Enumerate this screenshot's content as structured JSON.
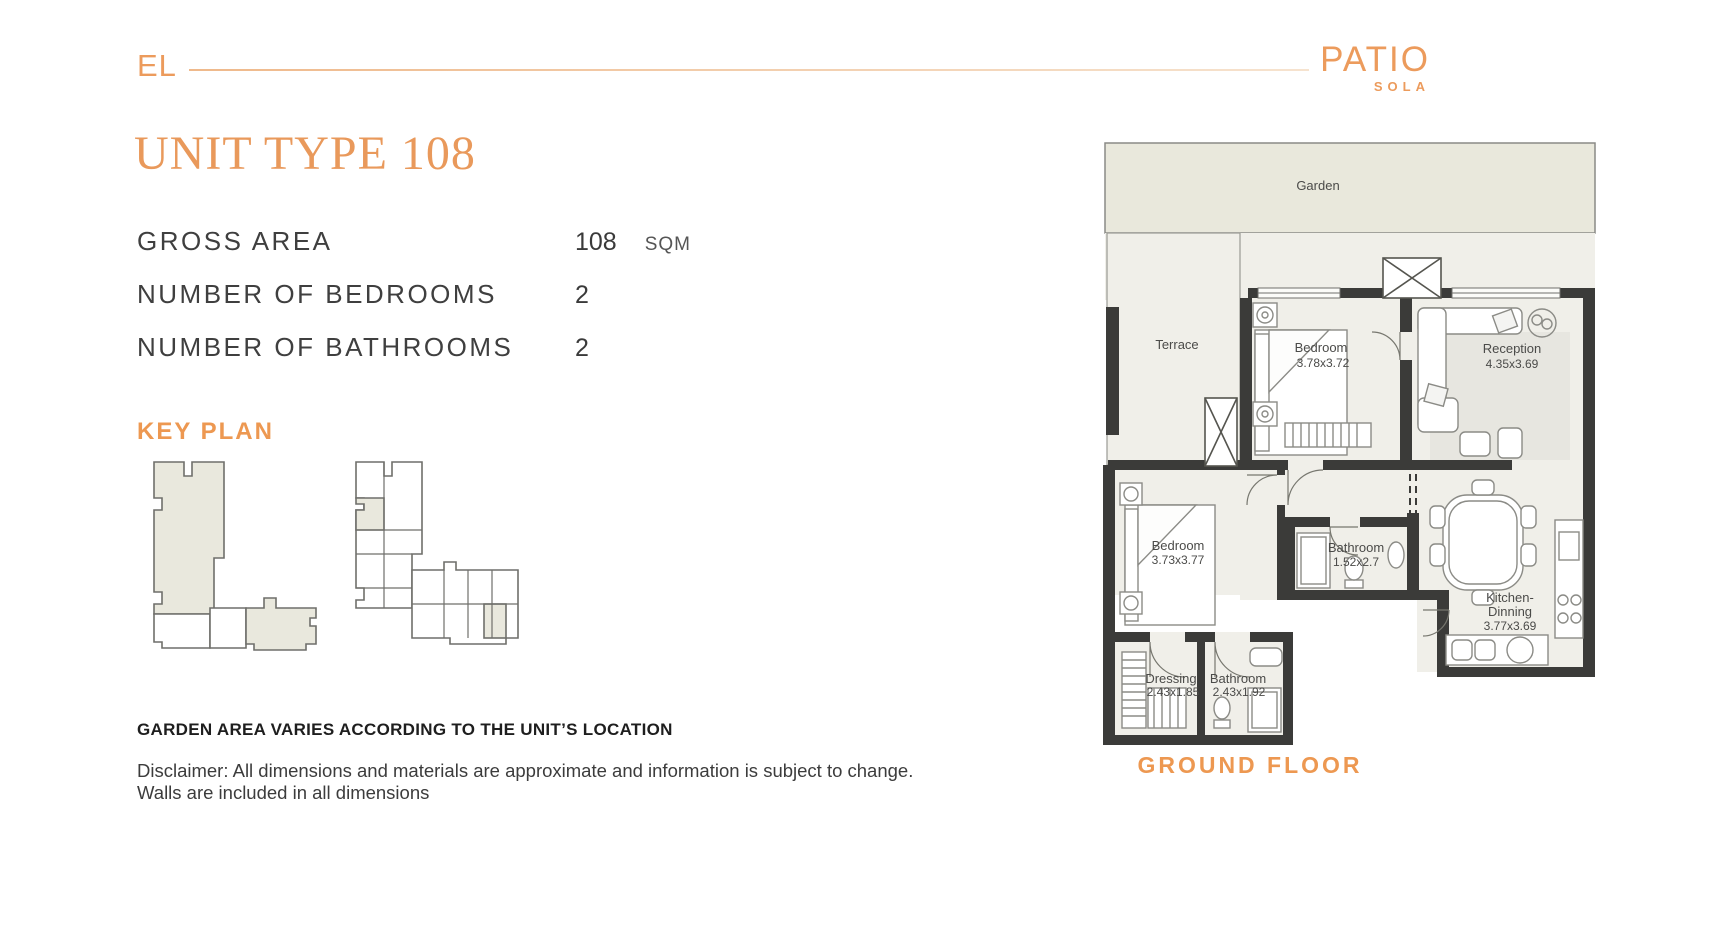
{
  "brand": {
    "logo_left": "EL",
    "logo_right_title": "PATIO",
    "logo_right_subtitle": "SOLA"
  },
  "title": "UNIT TYPE 108",
  "specs": [
    {
      "label": "GROSS AREA",
      "value": "108",
      "unit": "SQM"
    },
    {
      "label": "NUMBER OF BEDROOMS",
      "value": "2",
      "unit": ""
    },
    {
      "label": "NUMBER OF BATHROOMS",
      "value": "2",
      "unit": ""
    }
  ],
  "key_plan": {
    "heading": "KEY PLAN"
  },
  "floorplan": {
    "garden_label": "Garden",
    "floor_label": "GROUND FLOOR",
    "rooms": [
      {
        "name": "Terrace",
        "dims": ""
      },
      {
        "name": "Bedroom",
        "dims": "3.78x3.72"
      },
      {
        "name": "Reception",
        "dims": "4.35x3.69"
      },
      {
        "name": "Bedroom",
        "dims": "3.73x3.77"
      },
      {
        "name": "Bathroom",
        "dims": "1.52x2.7"
      },
      {
        "name": "Kitchen-",
        "name2": "Dinning",
        "dims": "3.77x3.69"
      },
      {
        "name": "Dressing",
        "dims": "2.43x1.85"
      },
      {
        "name": "Bathroom",
        "dims": "2.43x1.92"
      }
    ]
  },
  "notes": {
    "garden_note": "GARDEN AREA VARIES ACCORDING TO THE UNIT’S LOCATION",
    "disclaimer_line1": "Disclaimer: All dimensions and materials are approximate and information is subject to change.",
    "disclaimer_line2": "Walls are included in all dimensions"
  },
  "colors": {
    "accent_orange": "#EC9B5C",
    "heading_orange": "#ED9851",
    "title_orange": "#E9995B",
    "wall_dark": "#3B3B39",
    "garden_fill": "#E9E8DC",
    "floor_fill": "#F0EFE9",
    "text_dark": "#3E3E3E"
  }
}
